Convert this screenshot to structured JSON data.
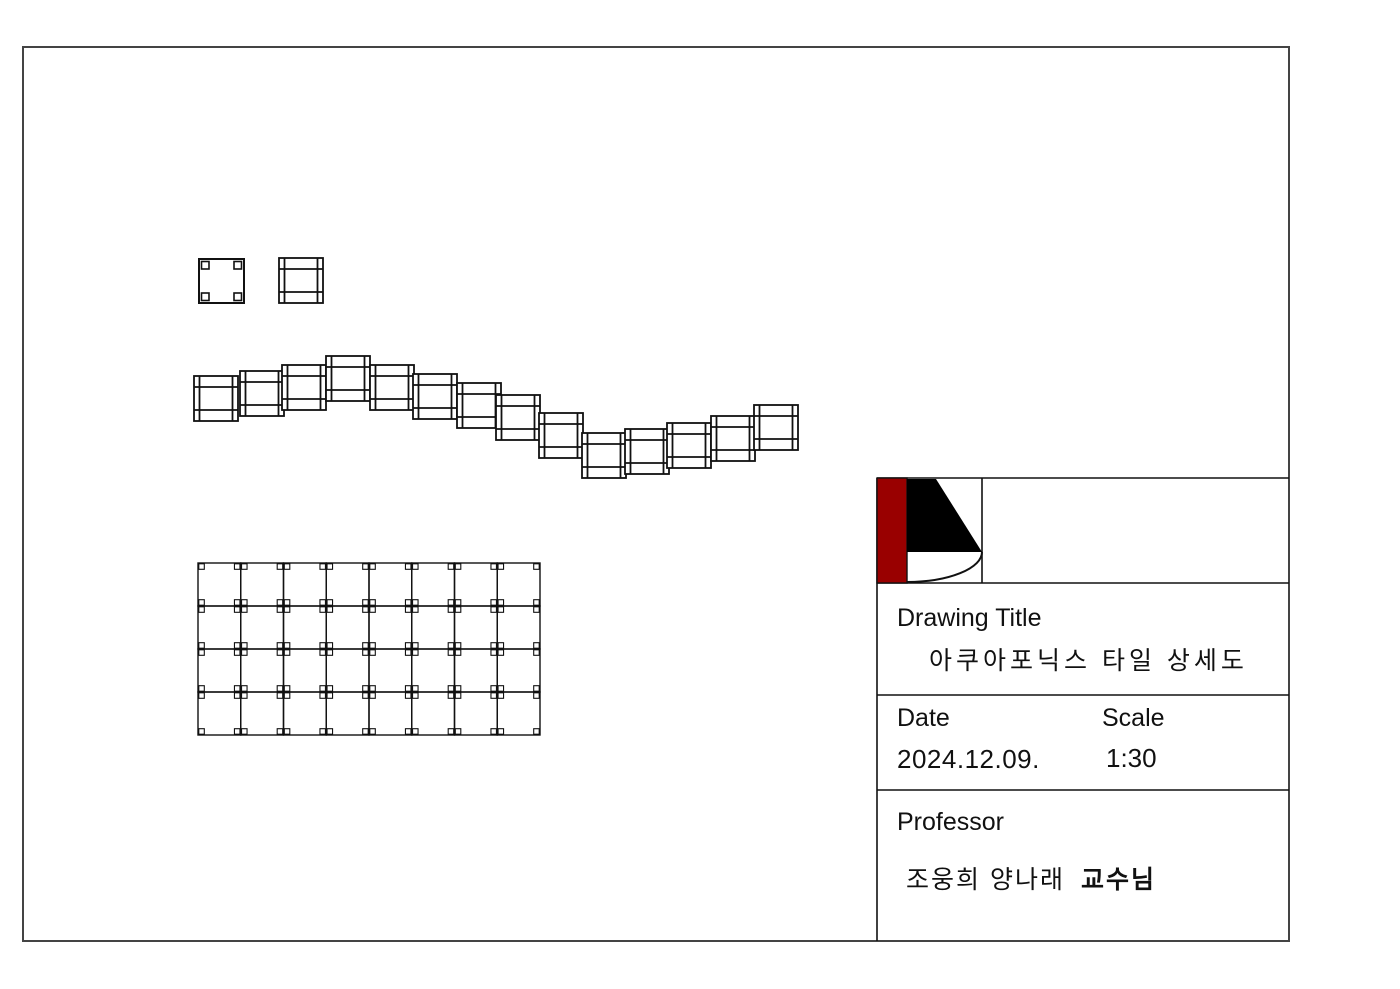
{
  "colors": {
    "background": "#ffffff",
    "line": "#111111",
    "sheet_border": "#444444",
    "logo_red": "#990000",
    "logo_black": "#000000",
    "text": "#111111"
  },
  "title_block": {
    "drawing_title_label": "Drawing Title",
    "drawing_title_value": "아쿠아포닉스 타일 상세도",
    "date_label": "Date",
    "date_value": "2024.12.09.",
    "scale_label": "Scale",
    "scale_value": "1:30",
    "professor_label": "Professor",
    "professor_names": "조웅희 양나래",
    "professor_honorific": "교수님"
  },
  "geometry": {
    "sheet_border": {
      "x": 23,
      "y": 47,
      "width": 1266,
      "height": 894
    },
    "title_block": {
      "left": 877,
      "top": 478,
      "right": 1289,
      "bottom": 941,
      "row_dividers": [
        583,
        695,
        790
      ],
      "logo_divider_x": 982,
      "logo": {
        "red_bar": {
          "x": 877,
          "y": 478,
          "width": 30,
          "height": 105
        },
        "triangle_points": "907,479 936,479 982,552 907,552",
        "arc_path": "M 907 582 A 75 30 0 0 0 982 552"
      }
    },
    "plan_tile_detail": {
      "x": 199,
      "y": 259,
      "width": 45,
      "height": 44,
      "corner_size": 7.5,
      "corner_inset": 2.5
    },
    "section_tile_detail": {
      "x": 279,
      "y": 258
    },
    "section_tile": {
      "width": 44,
      "height": 45,
      "v_inset": 5.5,
      "h_line1": 11,
      "h_line2": 34
    },
    "wave_tiles": [
      [
        194,
        376
      ],
      [
        240,
        371
      ],
      [
        282,
        365
      ],
      [
        326,
        356
      ],
      [
        370,
        365
      ],
      [
        413,
        374
      ],
      [
        457,
        383
      ],
      [
        496,
        395
      ],
      [
        539,
        413
      ],
      [
        582,
        433
      ],
      [
        625,
        429
      ],
      [
        667,
        423
      ],
      [
        711,
        416
      ],
      [
        754,
        405
      ]
    ],
    "grid": {
      "x": 198,
      "y": 563,
      "cols": 8,
      "rows": 4,
      "cell_width": 42.75,
      "cell_height": 43,
      "corner_size": 5.5,
      "corner_inset": 0.8
    }
  }
}
